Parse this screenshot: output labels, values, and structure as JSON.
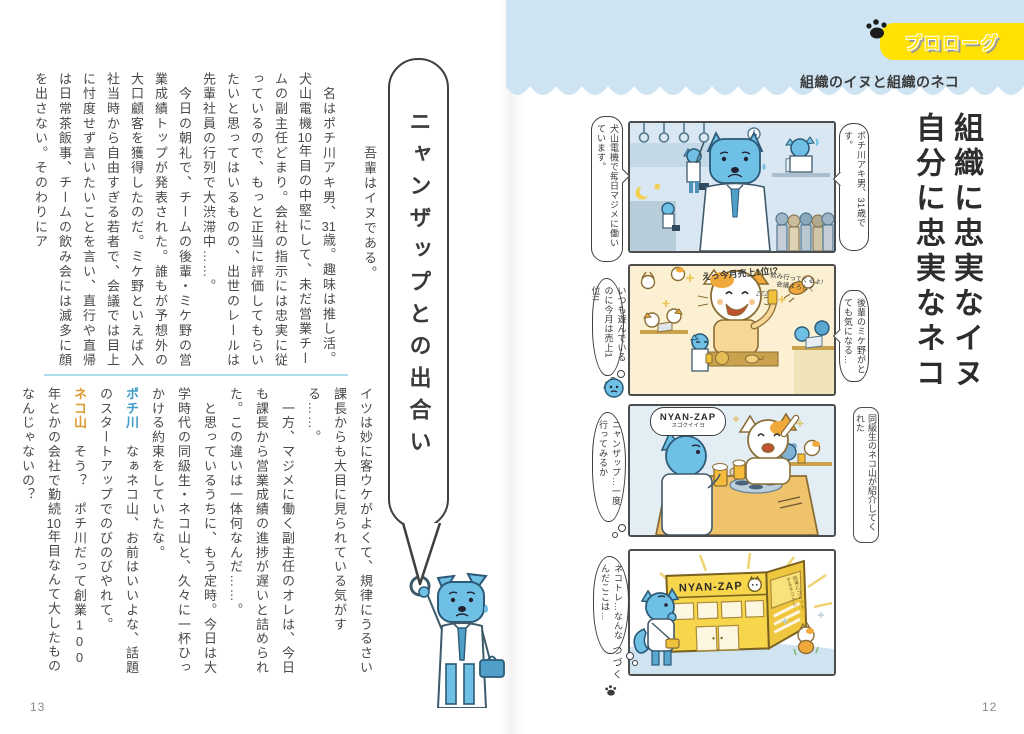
{
  "colors": {
    "badge_yellow": "#ffe103",
    "band_blue": "#cfe4f3",
    "dog_blue": "#6fc0e5",
    "cat_orange": "#f2a93b",
    "speaker_blue": "#3e9cc7",
    "speaker_orange": "#dd9a2e"
  },
  "left_page": {
    "page_number": "13",
    "heading": "ニャンザップとの出合い",
    "block1": [
      {
        "runs": [
          {
            "t": "　名はポチ川アキ男、"
          },
          {
            "t": "31",
            "s": "tcy"
          },
          {
            "t": "歳。趣味は推し活。犬山電機"
          },
          {
            "t": "10",
            "s": "tcy"
          },
          {
            "t": "年目の中堅にして、未だ営業チームの副主任どまり。会社の指示には忠実に従っているので、もっと正当に評価してもらいたいと思ってはいるものの、出世のレールは先輩社員の行列で大渋滞中……。"
          }
        ]
      },
      {
        "runs": [
          {
            "t": "　今日の朝礼で、チームの後輩・ミケ野の営業成績トップが発表された。誰もが予想外の大口顧客を獲得したのだ。ミケ野といえば入社当時から自由すぎる若者で、会議では目上に忖度せず言いたいことを言い、直行や直帰は日常茶飯事、チームの飲み会には滅多に顔を出さない。そのわりにア"
          }
        ]
      }
    ],
    "intro": "吾輩はイヌである。",
    "block2": [
      {
        "runs": [
          {
            "t": "イツは妙に客ウケがよくて、規律にうるさい課長からも大目に見られている気がする……。"
          }
        ]
      },
      {
        "runs": [
          {
            "t": "　一方、マジメに働く副主任のオレは、今日も課長から営業成績の進捗が遅いと詰められた。この違いは一体何なんだ……。"
          }
        ]
      },
      {
        "runs": [
          {
            "t": "　と思っているうちに、もう定時。今日は大学時代の同級生・ネコ山と、久々に一杯ひっかける約束をしていたな。"
          }
        ]
      },
      {
        "runs": [
          {
            "t": "ポチ川",
            "s": "speaker-blue"
          },
          {
            "t": "　なぁネコ山、お前はいいよな、話題のスタートアップでのびのびやれて。"
          }
        ]
      },
      {
        "runs": [
          {
            "t": "ネコ山",
            "s": "speaker-orange"
          },
          {
            "t": "　そう？　ポチ川だって創業"
          },
          {
            "t": "100",
            "s": "upright"
          },
          {
            "t": "年とかの会社で勤続"
          },
          {
            "t": "10",
            "s": "tcy"
          },
          {
            "t": "年目なんて大したものなんじゃないの？"
          }
        ]
      }
    ]
  },
  "right_page": {
    "page_number": "12",
    "badge": "プロローグ",
    "subtitle": "組織のイヌと組織のネコ",
    "title_lines": [
      "組織に忠実なイヌ",
      "自分に忠実なネコ"
    ],
    "panels": [
      {
        "right_bubble": "ポチ川アキ男、31歳です。",
        "left_bubble": "犬山電機で毎日マジメに働いています。"
      },
      {
        "right_bubble": "後輩のミケ野がとても気になる…",
        "left_bubble": "いつも遊んでいるのに今月は売上1位!!",
        "shout": "えっ今月売上1位!?",
        "note1": "飲み行ってくるよ!",
        "note2": "会議よろしく",
        "zzz": "ZZZ"
      },
      {
        "speech_title": "NYAN-ZAP",
        "speech_sub": "スゴクイイヨ",
        "right_caption": "同級生のネコ山が紹介してくれた",
        "left_bubble": "ニャンザップ…一度行ってみるか"
      },
      {
        "left_bubble": "ネコトレ…なんなんだここは…",
        "sign_main": "NYAN-ZAP",
        "sign_side": "結果にコミットするネコトレ",
        "to_be_continued": "つづく"
      }
    ]
  }
}
